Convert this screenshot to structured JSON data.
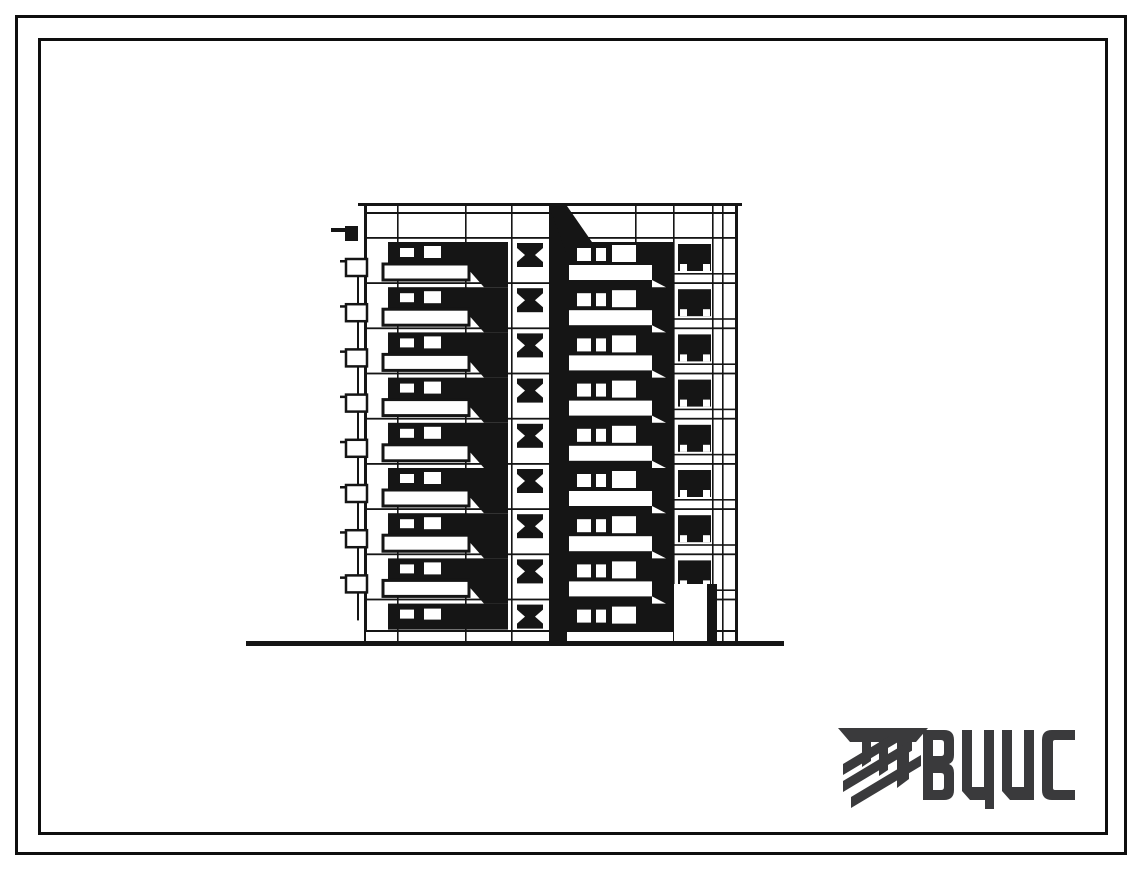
{
  "page": {
    "background": "#ffffff",
    "frame_color": "#0e0e0e"
  },
  "elevation": {
    "ink": "#151515",
    "floors": 9,
    "stair_windows": 9,
    "balcony_rows_left": 8,
    "balcony_rows_right": 8,
    "balcony_end_profiles": 8,
    "right_panel_window_rows": 8,
    "has_ground_entrance": true
  },
  "logo": {
    "text": "ВЦИС",
    "color": "#3a3a3c"
  }
}
